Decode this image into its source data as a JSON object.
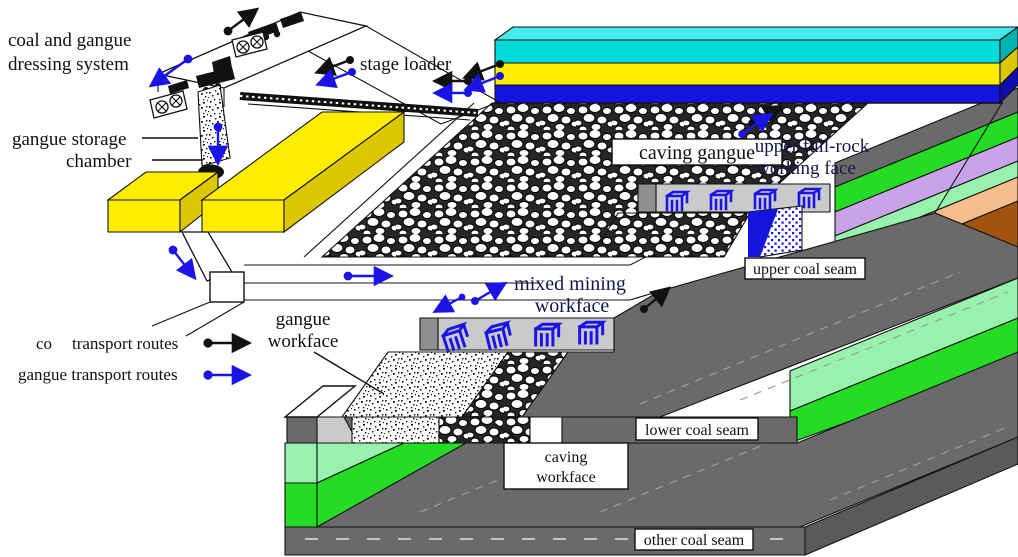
{
  "colors": {
    "cyan_top": "#45EAEA",
    "cyan": "#00DCDC",
    "cyan_dark": "#00B2B2",
    "yellow": "#FFED00",
    "yellow_dark": "#DCC800",
    "blue_stratum": "#1414DC",
    "blue_dark": "#0E0EB0",
    "machine_blue": "#1A14E6",
    "gray_light": "#CACACA",
    "gray_mid": "#8F8F8F",
    "gray_slab": "#6A6A6A",
    "gray_slab_dark": "#5A5A5A",
    "green": "#24DC24",
    "mint": "#98F2AE",
    "purple": "#C9A2E8",
    "peach": "#F5BE8A",
    "brown": "#A2540E",
    "ink": "#111111",
    "label_blue": "#16164E"
  },
  "labels": {
    "dressing_system_line1": "coal and gangue",
    "dressing_system_line2": "dressing system",
    "gangue_storage_line1": "gangue storage",
    "gangue_storage_line2": "chamber",
    "stage_loader": "stage loader",
    "caving_gangue": "caving gangue",
    "upper_face_line1": "upper full-rock",
    "upper_face_line2": "working face",
    "upper_coal_seam": "upper coal seam",
    "mixed_face_line1": "mixed mining",
    "mixed_face_line2": "workface",
    "gangue_workface_line1": "gangue",
    "gangue_workface_line2": "workface",
    "lower_coal_seam": "lower coal seam",
    "caving_workface_line1": "caving",
    "caving_workface_line2": "workface",
    "other_coal_seam": "other coal seam"
  },
  "legend": {
    "coal_route_prefix": "co",
    "coal_route_label": "transport routes",
    "gangue_route_label": "gangue transport routes"
  }
}
